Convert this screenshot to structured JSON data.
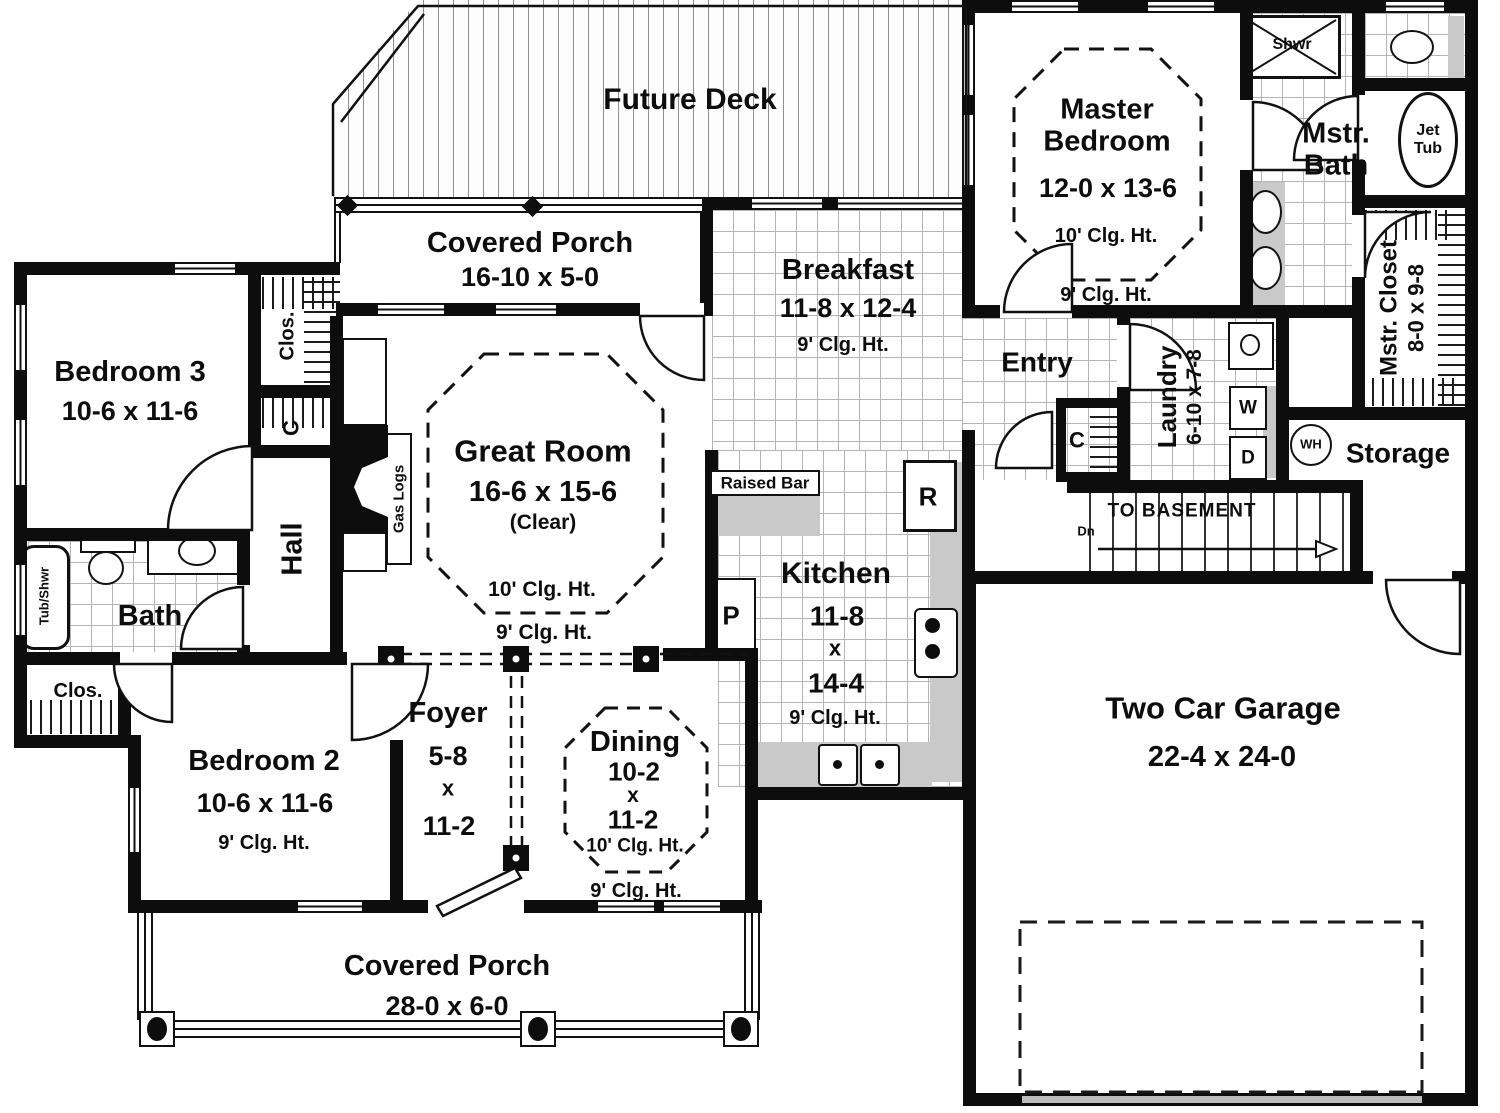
{
  "palette": {
    "wall": "#0d0d0d",
    "tile_line": "#b4b4b4",
    "counter": "#c9c9c9"
  },
  "deck": {
    "name": "Future Deck"
  },
  "porch_top": {
    "name": "Covered Porch",
    "dims": "16-10 x 5-0"
  },
  "breakfast": {
    "name": "Breakfast",
    "dims": "11-8 x 12-4",
    "clg": "9' Clg. Ht."
  },
  "master_bedroom": {
    "name": "Master Bedroom",
    "dims": "12-0 x 13-6",
    "clg_inner": "10' Clg. Ht.",
    "clg": "9' Clg. Ht."
  },
  "master_bath": {
    "name": "Mstr. Bath",
    "shower": "Shwr",
    "tub_line1": "Jet",
    "tub_line2": "Tub"
  },
  "master_closet": {
    "name": "Mstr. Closet",
    "dims": "8-0 x 9-8"
  },
  "laundry": {
    "name": "Laundry",
    "dims": "6-10 x 7-8",
    "washer": "W",
    "dryer": "D"
  },
  "storage": {
    "name": "Storage",
    "water_heater": "WH"
  },
  "stairs": {
    "label": "TO BASEMENT",
    "down": "Dn"
  },
  "entry": {
    "name": "Entry",
    "closet": "C"
  },
  "great_room": {
    "name": "Great Room",
    "dims": "16-6 x 15-6",
    "clear": "(Clear)",
    "clg_inner": "10' Clg. Ht.",
    "clg": "9' Clg. Ht.",
    "gas_logs": "Gas Logs"
  },
  "bedroom3": {
    "name": "Bedroom 3",
    "dims": "10-6 x 11-6",
    "closet": "Clos.",
    "hall_closet": "C"
  },
  "hall": {
    "name": "Hall"
  },
  "bath": {
    "name": "Bath",
    "tub": "Tub/Shwr"
  },
  "bedroom2": {
    "name": "Bedroom 2",
    "dims": "10-6 x 11-6",
    "clg": "9' Clg. Ht.",
    "closet": "Clos."
  },
  "foyer": {
    "name": "Foyer",
    "dims_w": "5-8",
    "dims_x": "x",
    "dims_h": "11-2"
  },
  "dining": {
    "name": "Dining",
    "dims_w": "10-2",
    "dims_x": "x",
    "dims_h": "11-2",
    "clg_inner": "10' Clg. Ht.",
    "clg": "9' Clg. Ht."
  },
  "kitchen": {
    "name": "Kitchen",
    "dims_w": "11-8",
    "dims_x": "x",
    "dims_h": "14-4",
    "clg": "9' Clg. Ht.",
    "fridge": "R",
    "pantry": "P",
    "raised_bar": "Raised Bar"
  },
  "garage": {
    "name": "Two Car Garage",
    "dims": "22-4 x 24-0"
  },
  "porch_bottom": {
    "name": "Covered Porch",
    "dims": "28-0 x 6-0"
  }
}
